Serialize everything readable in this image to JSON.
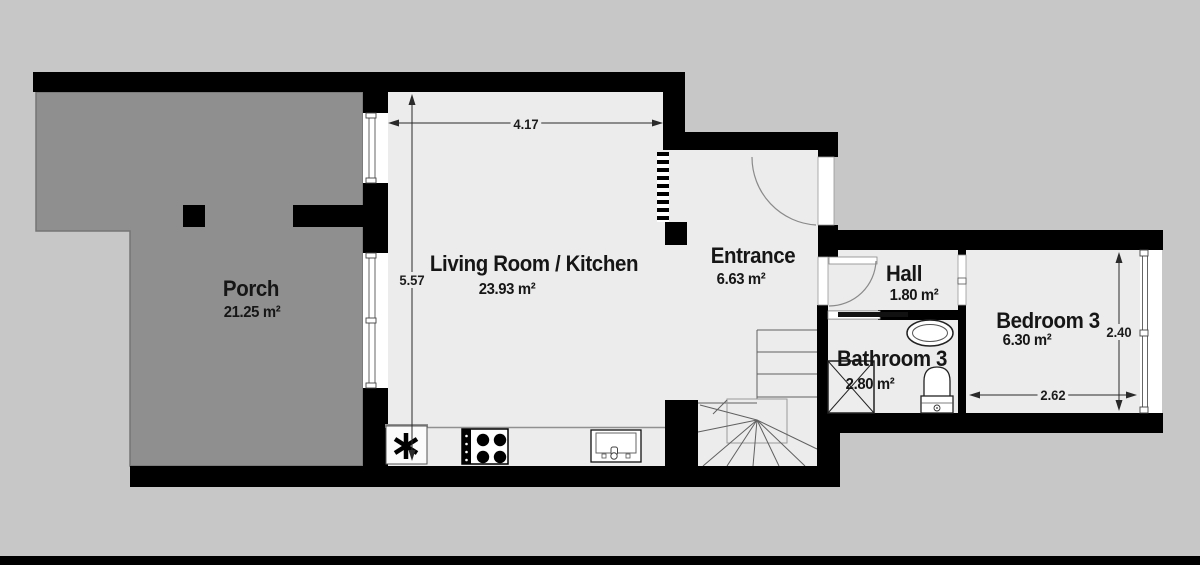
{
  "plan": {
    "rooms": [
      {
        "id": "porch",
        "name": "Porch",
        "area": "21.25 m²"
      },
      {
        "id": "living",
        "name": "Living Room / Kitchen",
        "area": "23.93 m²"
      },
      {
        "id": "entrance",
        "name": "Entrance",
        "area": "6.63 m²"
      },
      {
        "id": "hall",
        "name": "Hall",
        "area": "1.80 m²"
      },
      {
        "id": "bathroom",
        "name": "Bathroom 3",
        "area": "2.80 m²"
      },
      {
        "id": "bedroom",
        "name": "Bedroom 3",
        "area": "6.30 m²"
      }
    ],
    "dimensions": {
      "living_width": "4.17",
      "living_height": "5.57",
      "bedroom_height": "2.40",
      "bedroom_width": "2.62"
    },
    "fixtures": [
      "boiler-asterisk",
      "stove",
      "kitchen-sink",
      "staircase",
      "shower",
      "washbasin",
      "toilet"
    ],
    "colors": {
      "wall": "#000000",
      "floor": "#ececec",
      "porch": "#8f8f8f",
      "background": "#c7c7c7"
    }
  }
}
